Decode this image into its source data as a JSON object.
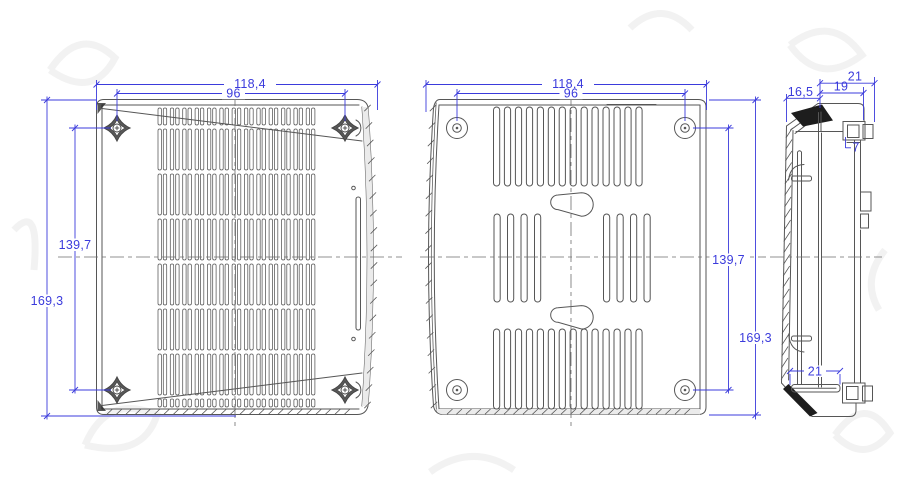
{
  "colors": {
    "background": "#ffffff",
    "drawing_line": "#565656",
    "dimension": "#3b3bdc",
    "solid_fill": "#1d1d1d",
    "band_fill": "#ebebeb"
  },
  "front_view": {
    "dimensions": {
      "overall_width": "118,4",
      "mount_hole_span_x": "96",
      "mount_hole_span_y": "139,7",
      "overall_height": "169,3"
    },
    "grille_columns": 13,
    "grille_rows": 8,
    "mount_bosses": 4
  },
  "back_view": {
    "dimensions": {
      "overall_width": "118,4",
      "mount_hole_span_x": "96",
      "mount_hole_span_y": "139,7",
      "overall_height": "169,3"
    },
    "vent_slots_top": 14,
    "vent_slots_bottom": 14,
    "vent_slots_mid_left": 4,
    "vent_slots_mid_right": 4,
    "keyhole_slots": 2,
    "mount_holes": 4
  },
  "side_view": {
    "dimensions": {
      "depth_overall": "21",
      "depth_minus_lip": "19",
      "body_depth": "16,5",
      "tab_depth": "7",
      "bottom_depth": "21"
    }
  }
}
